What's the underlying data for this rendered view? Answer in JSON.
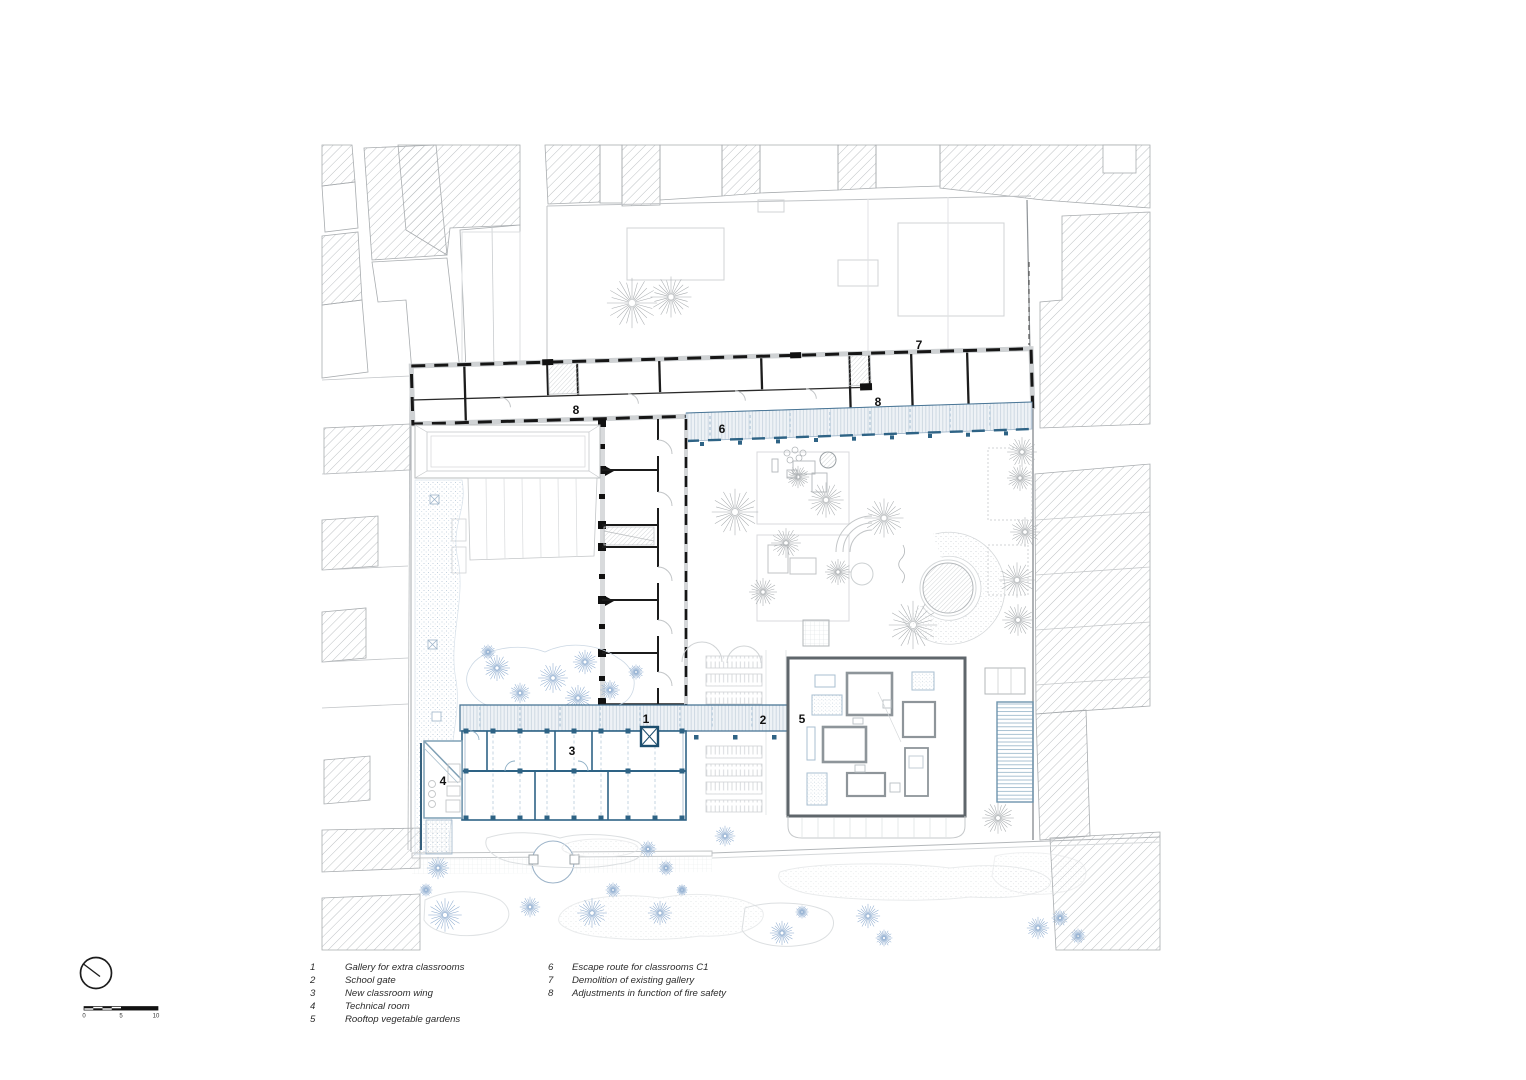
{
  "plan": {
    "marks": {
      "m1": "1",
      "m2": "2",
      "m3": "3",
      "m4": "4",
      "m5": "5",
      "m6": "6",
      "m7": "7",
      "m8a": "8",
      "m8b": "8"
    }
  },
  "legend": {
    "col1": [
      {
        "num": "1",
        "label": "Gallery for extra classrooms"
      },
      {
        "num": "2",
        "label": "School gate"
      },
      {
        "num": "3",
        "label": "New classroom wing"
      },
      {
        "num": "4",
        "label": "Technical room"
      },
      {
        "num": "5",
        "label": "Rooftop vegetable gardens"
      }
    ],
    "col2": [
      {
        "num": "6",
        "label": "Escape route for classrooms C1"
      },
      {
        "num": "7",
        "label": "Demolition of existing gallery"
      },
      {
        "num": "8",
        "label": "Adjustments in function of fire safety"
      }
    ]
  },
  "scalebar": {
    "t0": "0",
    "t5": "5",
    "t10": "10"
  },
  "colors": {
    "new_construction_blue": "#2e6385",
    "light_blue": "#aac3d6",
    "tree_blue": "#8fadd0",
    "demolition_black": "#161616",
    "context_gray": "#a8acaf"
  }
}
